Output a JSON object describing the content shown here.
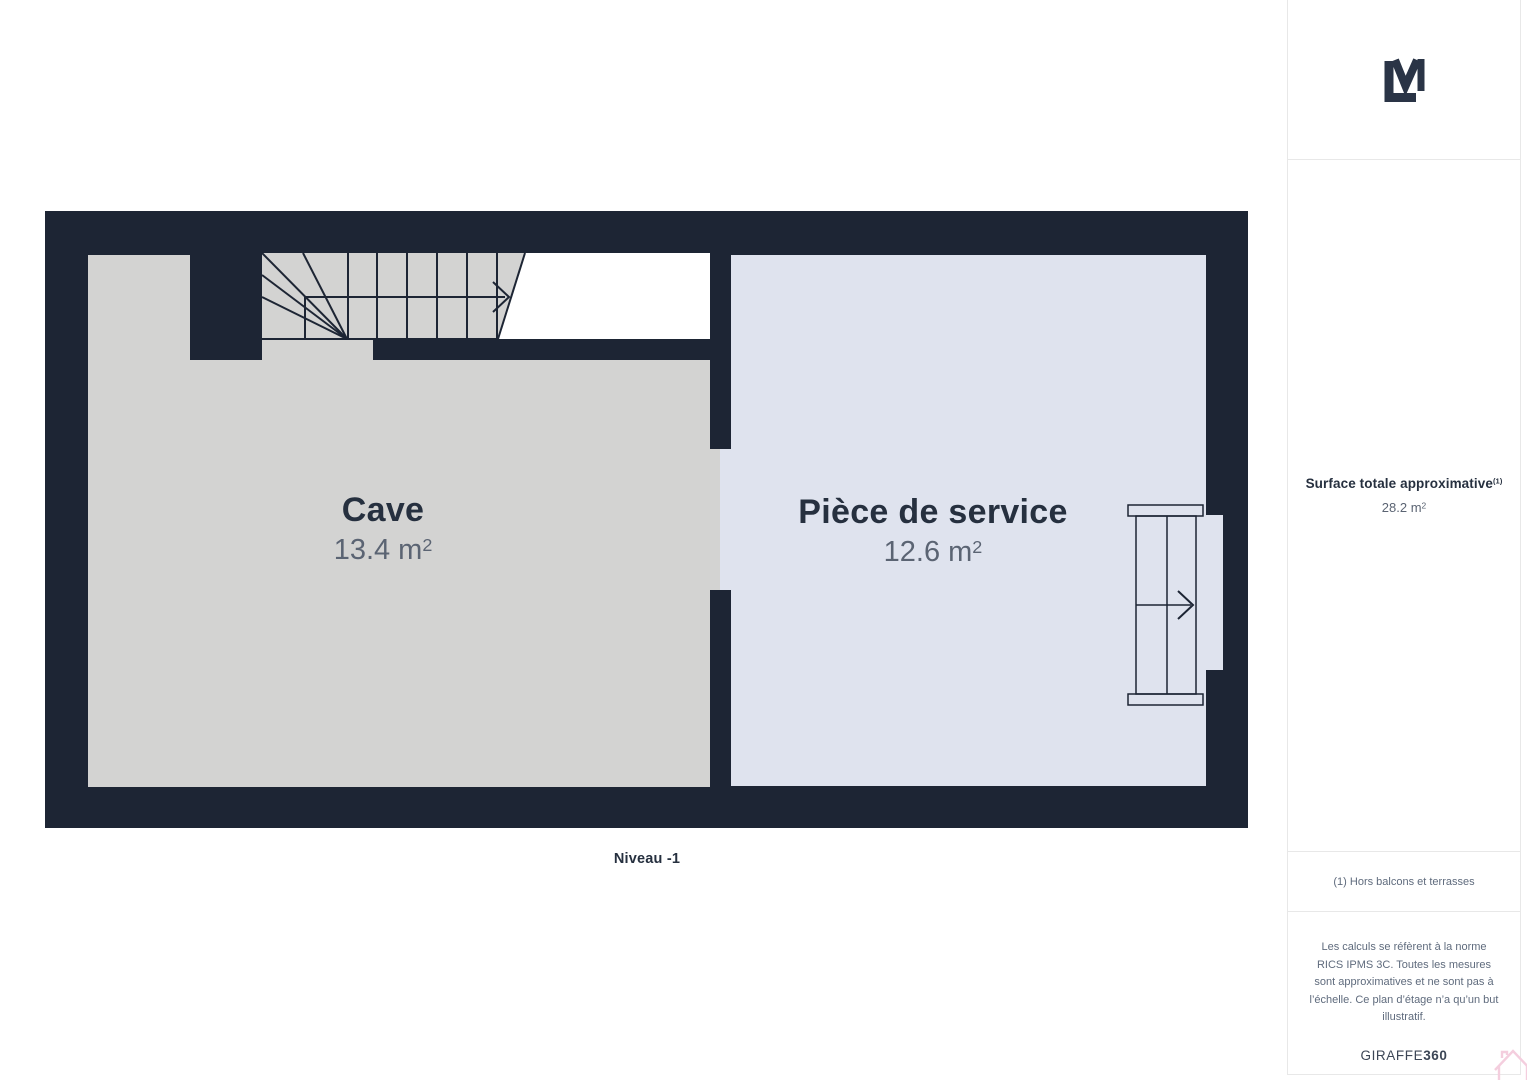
{
  "plan": {
    "level_label": "Niveau -1",
    "rooms": [
      {
        "name": "Cave",
        "area_value": "13.4",
        "area_unit": "m",
        "area_exponent": "2"
      },
      {
        "name": "Pièce de service",
        "area_value": "12.6",
        "area_unit": "m",
        "area_exponent": "2"
      }
    ]
  },
  "sidebar": {
    "surface": {
      "title": "Surface totale approximative",
      "footnote_marker": "(1)",
      "value": "28.2",
      "unit": "m",
      "exponent": "2"
    },
    "footnote": "(1) Hors balcons et terrasses",
    "disclaimer": "Les calculs se réfèrent à la norme RICS IPMS 3C. Toutes les mesures sont approximatives et ne sont pas à l’échelle. Ce plan d’étage n’a qu’un but illustratif.",
    "brand_name": "GIRAFFE",
    "brand_suffix": "360"
  },
  "icons": {
    "logo": "lm-monogram",
    "watermark": "house-outline"
  },
  "colors": {
    "wall": "#1d2534",
    "cave_floor": "#d3d3d2",
    "service_floor": "#dfe3ee",
    "stair_void": "#ffffff",
    "label_dark": "#26303f",
    "label_grey": "#5b6473",
    "sidebar_text": "#5f6b7d",
    "divider": "#e8e8e8",
    "brand": "#3c4656",
    "watermark_pink": "#f4cede"
  }
}
